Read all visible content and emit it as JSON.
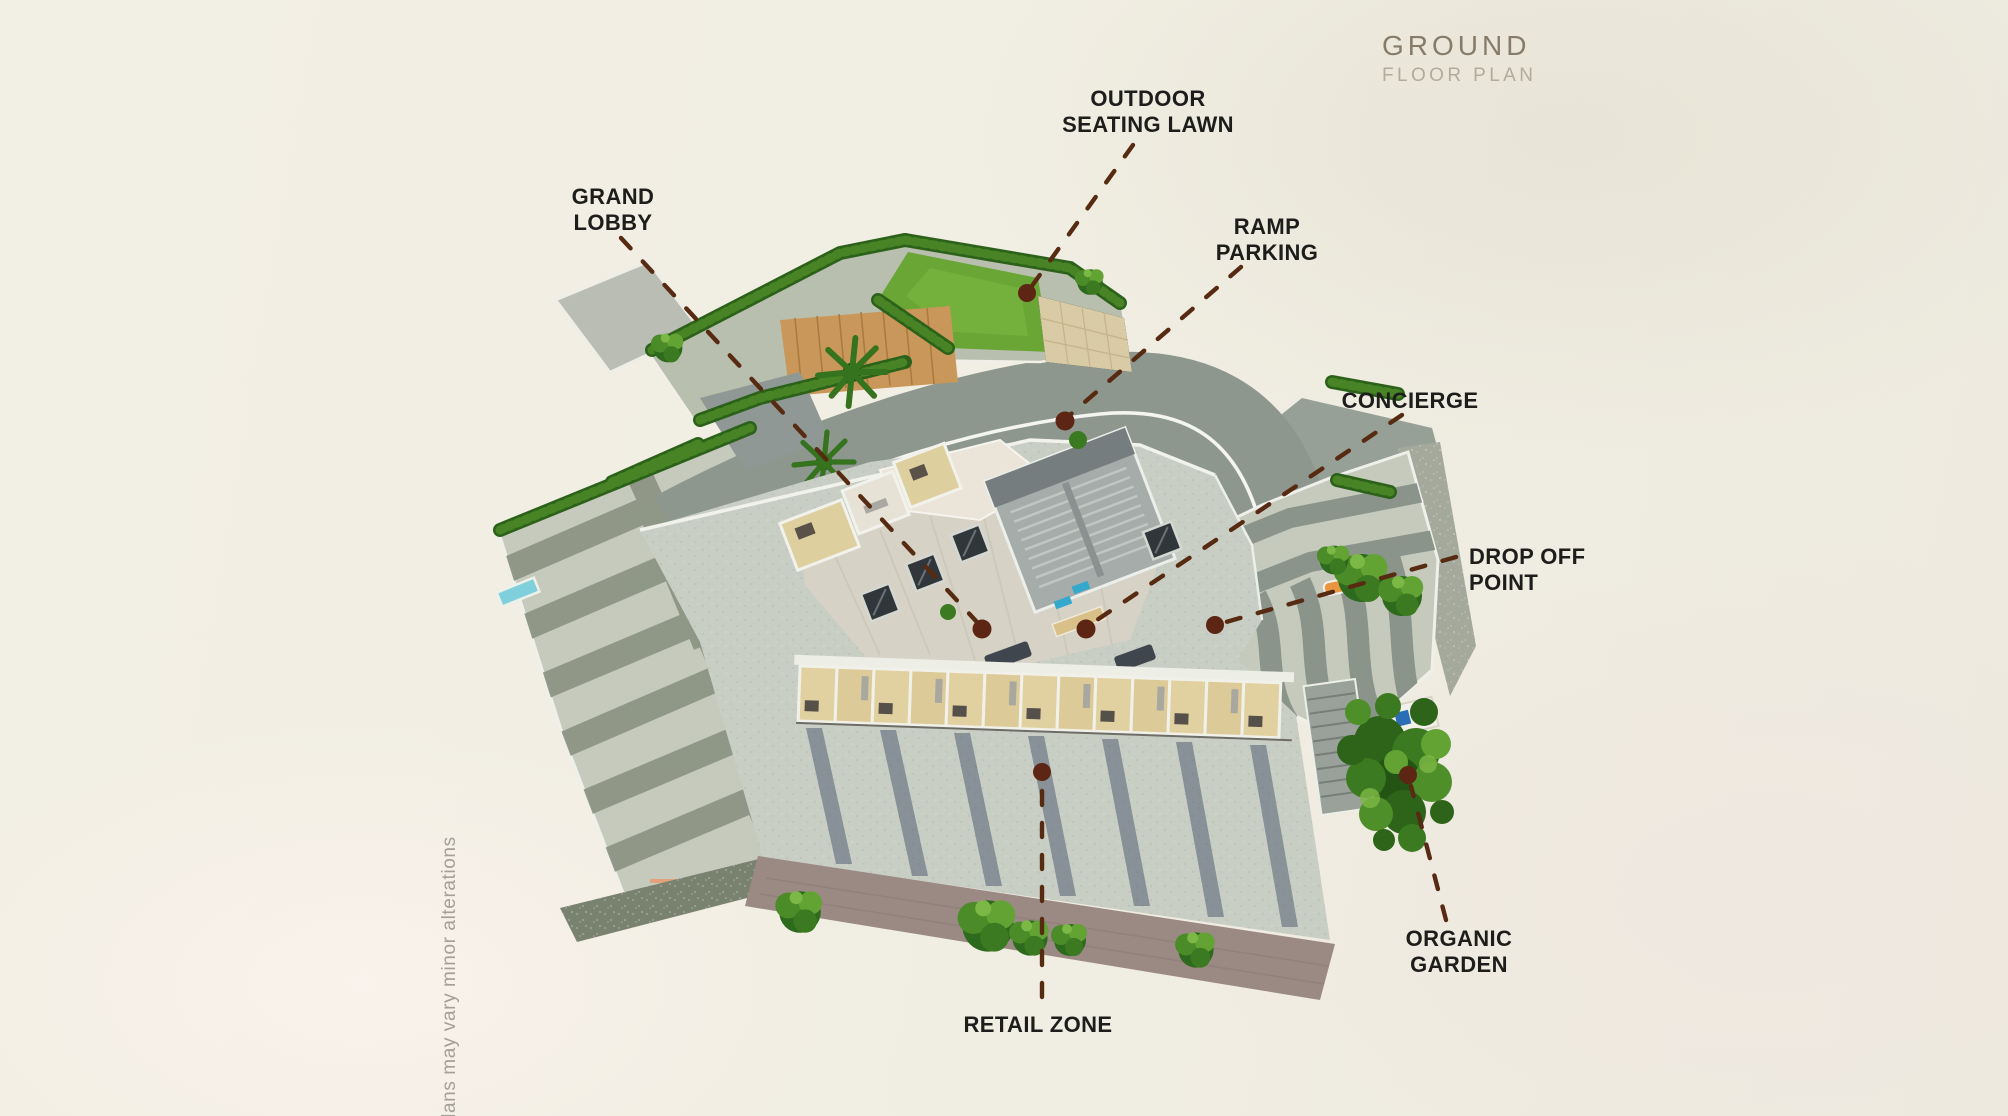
{
  "header": {
    "title_line1": "GROUND",
    "title_line2": "FLOOR PLAN"
  },
  "disclaimer": "plans may vary minor alterations",
  "annotations": {
    "outdoor_seating_lawn": {
      "line1": "OUTDOOR",
      "line2": "SEATING LAWN"
    },
    "grand_lobby": {
      "line1": "GRAND",
      "line2": "LOBBY"
    },
    "ramp_parking": {
      "line1": "RAMP",
      "line2": "PARKING"
    },
    "concierge": {
      "line1": "CONCIERGE",
      "line2": ""
    },
    "drop_off_point": {
      "line1": "DROP OFF",
      "line2": "POINT"
    },
    "organic_garden": {
      "line1": "ORGANIC",
      "line2": "GARDEN"
    },
    "retail_zone": {
      "line1": "RETAIL ZONE",
      "line2": ""
    }
  },
  "colors": {
    "background_cream": "#f1eee3",
    "label_text": "#1d1d1b",
    "title_primary": "#877c6a",
    "title_secondary": "#b3ab9a",
    "leader_dash": "#572a12",
    "marker_dot": "#5d2614",
    "plaza_light": "#c6cabc",
    "plaza_stripe": "#8b9383",
    "road_gray": "#8e978e",
    "road_line_white": "#f4f4f0",
    "lawn_green": "#6aa636",
    "hedge_green": "#2f6a1c",
    "deck_wood": "#c9975a",
    "podium_concrete": "#c9cec5",
    "courtyard_floor": "#d6d2c6",
    "unit_floor_beige": "#e2d1a0",
    "retail_road_mauve": "#9b8a84",
    "shadow_blue": "#47566a",
    "bench_orange": "#e8963f",
    "water_blue": "#7fd0dc"
  }
}
